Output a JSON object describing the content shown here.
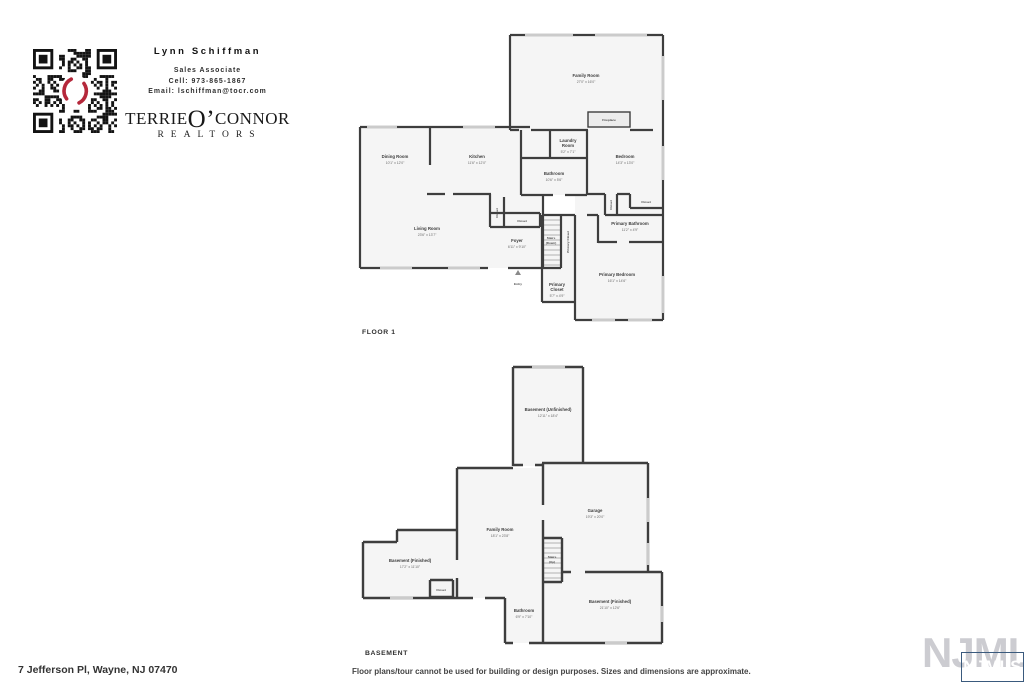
{
  "agent": {
    "name": "Lynn Schiffman",
    "title": "Sales Associate",
    "cell": "Cell: 973-865-1867",
    "email": "Email: lschiffman@tocr.com"
  },
  "brand": {
    "part1": "TERRIE",
    "o": "O’",
    "part2": "CONNOR",
    "realtors": "REALTORS"
  },
  "floor1": {
    "label": "FLOOR 1",
    "rooms": {
      "family_room": {
        "name": "Family Room",
        "dims": "27'0\" x 16'0\""
      },
      "fireplace": {
        "name": "Fireplace"
      },
      "dining_room": {
        "name": "Dining Room",
        "dims": "10'1\" x 12'0\""
      },
      "kitchen": {
        "name": "Kitchen",
        "dims": "11'6\" x 12'0\""
      },
      "laundry_room": {
        "line1": "Laundry",
        "line2": "Room",
        "dims": "5'2\" x 7'1\""
      },
      "bathroom": {
        "name": "Bathroom",
        "dims": "10'6\" x 5'6\""
      },
      "bedroom": {
        "name": "Bedroom",
        "dims": "14'3\" x 13'0\""
      },
      "living_room": {
        "name": "Living Room",
        "dims": "23'6\" x 13'7\""
      },
      "closet_kitchen": {
        "name": "Closet"
      },
      "closet_foyer": {
        "name": "Closet"
      },
      "closet_bedroom_a": {
        "name": "Closet"
      },
      "closet_bedroom_b": {
        "name": "Closet"
      },
      "foyer": {
        "name": "Foyer",
        "dims": "6'11\" x 9'10\""
      },
      "stairs": {
        "line1": "Stairs",
        "line2": "(Down)"
      },
      "primary_closet_hall": {
        "name": "Primary Closet"
      },
      "primary_bathroom": {
        "name": "Primary Bathroom",
        "dims": "11'2\" x 4'9\""
      },
      "primary_bedroom": {
        "name": "Primary Bedroom",
        "dims": "16'1\" x 14'6\""
      },
      "primary_closet": {
        "line1": "Primary",
        "line2": "Closet",
        "dims": "5'7\" x 4'9\""
      },
      "entry": {
        "name": "Entry"
      }
    }
  },
  "basement": {
    "label": "BASEMENT",
    "rooms": {
      "unfinished": {
        "name": "Basement (Unfinished)",
        "dims": "12'11\" x 18'4\""
      },
      "garage": {
        "name": "Garage",
        "dims": "19'3\" x 20'0\""
      },
      "family_room": {
        "name": "Family Room",
        "dims": "18'1\" x 23'8\""
      },
      "finished_left": {
        "name": "Basement (Finished)",
        "dims": "17'2\" x 11'10\""
      },
      "closet": {
        "name": "Closet"
      },
      "stairs": {
        "line1": "Stairs",
        "line2": "(Up)"
      },
      "bathroom": {
        "name": "Bathroom",
        "dims": "6'9\" x 7'10\""
      },
      "finished_right": {
        "name": "Basement (Finished)",
        "dims": "21'10\" x 12'6\""
      }
    }
  },
  "footer": {
    "address": "7 Jefferson Pl, Wayne, NJ 07470",
    "disclaimer": "Floor plans/tour cannot be used for building or design purposes. Sizes and dimensions are approximate.",
    "mls_watermark": "NJMLS",
    "mls_badge": "NJMLS"
  },
  "colors": {
    "wall": "#3e3e3e",
    "brand_red": "#b5283b",
    "mls_blue": "#2f6398",
    "watermark_gray": "#ccccd1"
  }
}
